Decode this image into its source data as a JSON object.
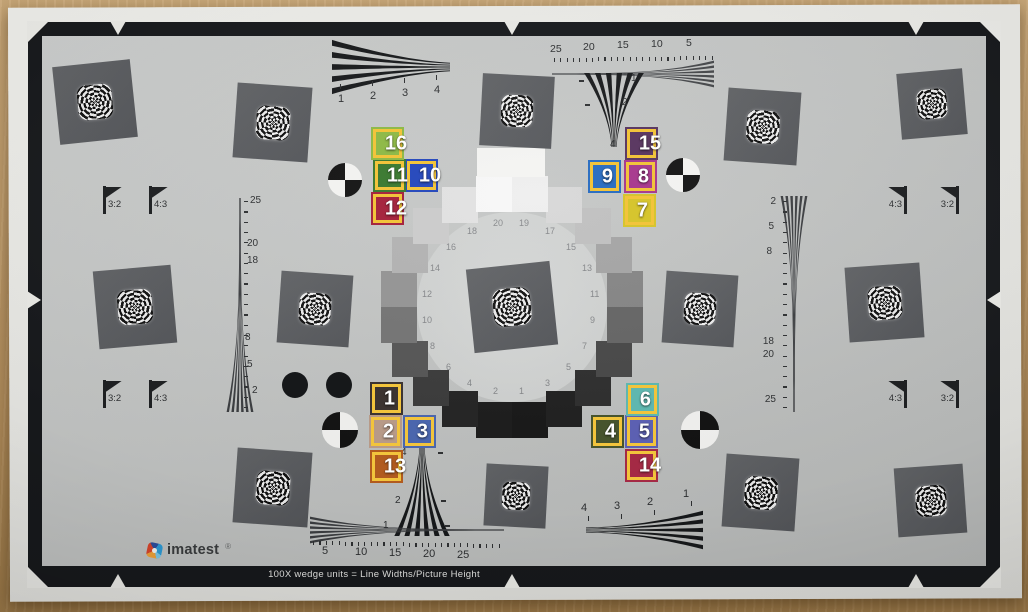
{
  "chart": {
    "brand": {
      "name": "imatest",
      "registered": "®"
    },
    "footer_text": "100X wedge units = Line Widths/Picture Height",
    "aspect_flags": {
      "top_left": [
        "3:2",
        "4:3"
      ],
      "top_right": [
        "4:3",
        "3:2"
      ],
      "bottom_left": [
        "3:2",
        "4:3"
      ],
      "bottom_right": [
        "4:3",
        "3:2"
      ]
    },
    "wedge_scales": {
      "top_left_horizontal": [
        "1",
        "2",
        "3",
        "4"
      ],
      "top_right_fine": [
        "25",
        "20",
        "15",
        "10",
        "5"
      ],
      "top_right_vertical": [
        "1",
        "2",
        "4"
      ],
      "left_vertical_fine": [
        "25",
        "20",
        "18",
        "8",
        "5",
        "2"
      ],
      "right_vertical_fine": [
        "2",
        "5",
        "8",
        "18",
        "20",
        "25"
      ],
      "bottom_center_vertical": [
        "4",
        "2",
        "1"
      ],
      "bottom_left_fine": [
        "5",
        "10",
        "15",
        "20",
        "25"
      ],
      "bottom_right_horizontal": [
        "4",
        "3",
        "2",
        "1"
      ]
    },
    "oecf_ring": {
      "patch_numbers": [
        "1",
        "2",
        "3",
        "4",
        "5",
        "6",
        "7",
        "8",
        "9",
        "10",
        "11",
        "12",
        "13",
        "14",
        "15",
        "16",
        "17",
        "18",
        "19",
        "20"
      ],
      "patch_shades": [
        "#171717",
        "#1b1b1b",
        "#1f1f1f",
        "#232323",
        "#2d2d2d",
        "#3a3a3a",
        "#474747",
        "#555555",
        "#646464",
        "#747474",
        "#848484",
        "#949494",
        "#a4a4a4",
        "#b2b2b2",
        "#bfbfbf",
        "#cbcbcb",
        "#d7d7d7",
        "#e1e1e1",
        "#eeeeee",
        "#f7f7f7"
      ]
    },
    "colors": {
      "frame_black": "#17191c",
      "chart_gray": "#c3c5c4",
      "paper_white": "#ebebe7"
    }
  },
  "annotations": {
    "border_color": "#f2c43c",
    "label_color": "#ffffff",
    "markers": [
      {
        "id": "1",
        "color": "#3c3431",
        "x": 370,
        "y": 382
      },
      {
        "id": "2",
        "color": "#b79a88",
        "x": 369,
        "y": 415
      },
      {
        "id": "3",
        "color": "#4b66ad",
        "x": 403,
        "y": 415
      },
      {
        "id": "4",
        "color": "#47542e",
        "x": 591,
        "y": 415
      },
      {
        "id": "5",
        "color": "#5c60b2",
        "x": 625,
        "y": 415
      },
      {
        "id": "6",
        "color": "#5fb7af",
        "x": 626,
        "y": 383
      },
      {
        "id": "7",
        "color": "#d6c52f",
        "x": 623,
        "y": 194
      },
      {
        "id": "8",
        "color": "#a93d90",
        "x": 624,
        "y": 160
      },
      {
        "id": "9",
        "color": "#2e70c2",
        "x": 588,
        "y": 160
      },
      {
        "id": "10",
        "color": "#2a4cbd",
        "x": 405,
        "y": 159
      },
      {
        "id": "11",
        "color": "#3f7c35",
        "x": 373,
        "y": 159
      },
      {
        "id": "12",
        "color": "#a62740",
        "x": 371,
        "y": 192
      },
      {
        "id": "13",
        "color": "#b15b1f",
        "x": 370,
        "y": 450
      },
      {
        "id": "14",
        "color": "#a42a45",
        "x": 625,
        "y": 449
      },
      {
        "id": "15",
        "color": "#5c3a63",
        "x": 625,
        "y": 127
      },
      {
        "id": "16",
        "color": "#90ba4a",
        "x": 371,
        "y": 127
      }
    ]
  }
}
